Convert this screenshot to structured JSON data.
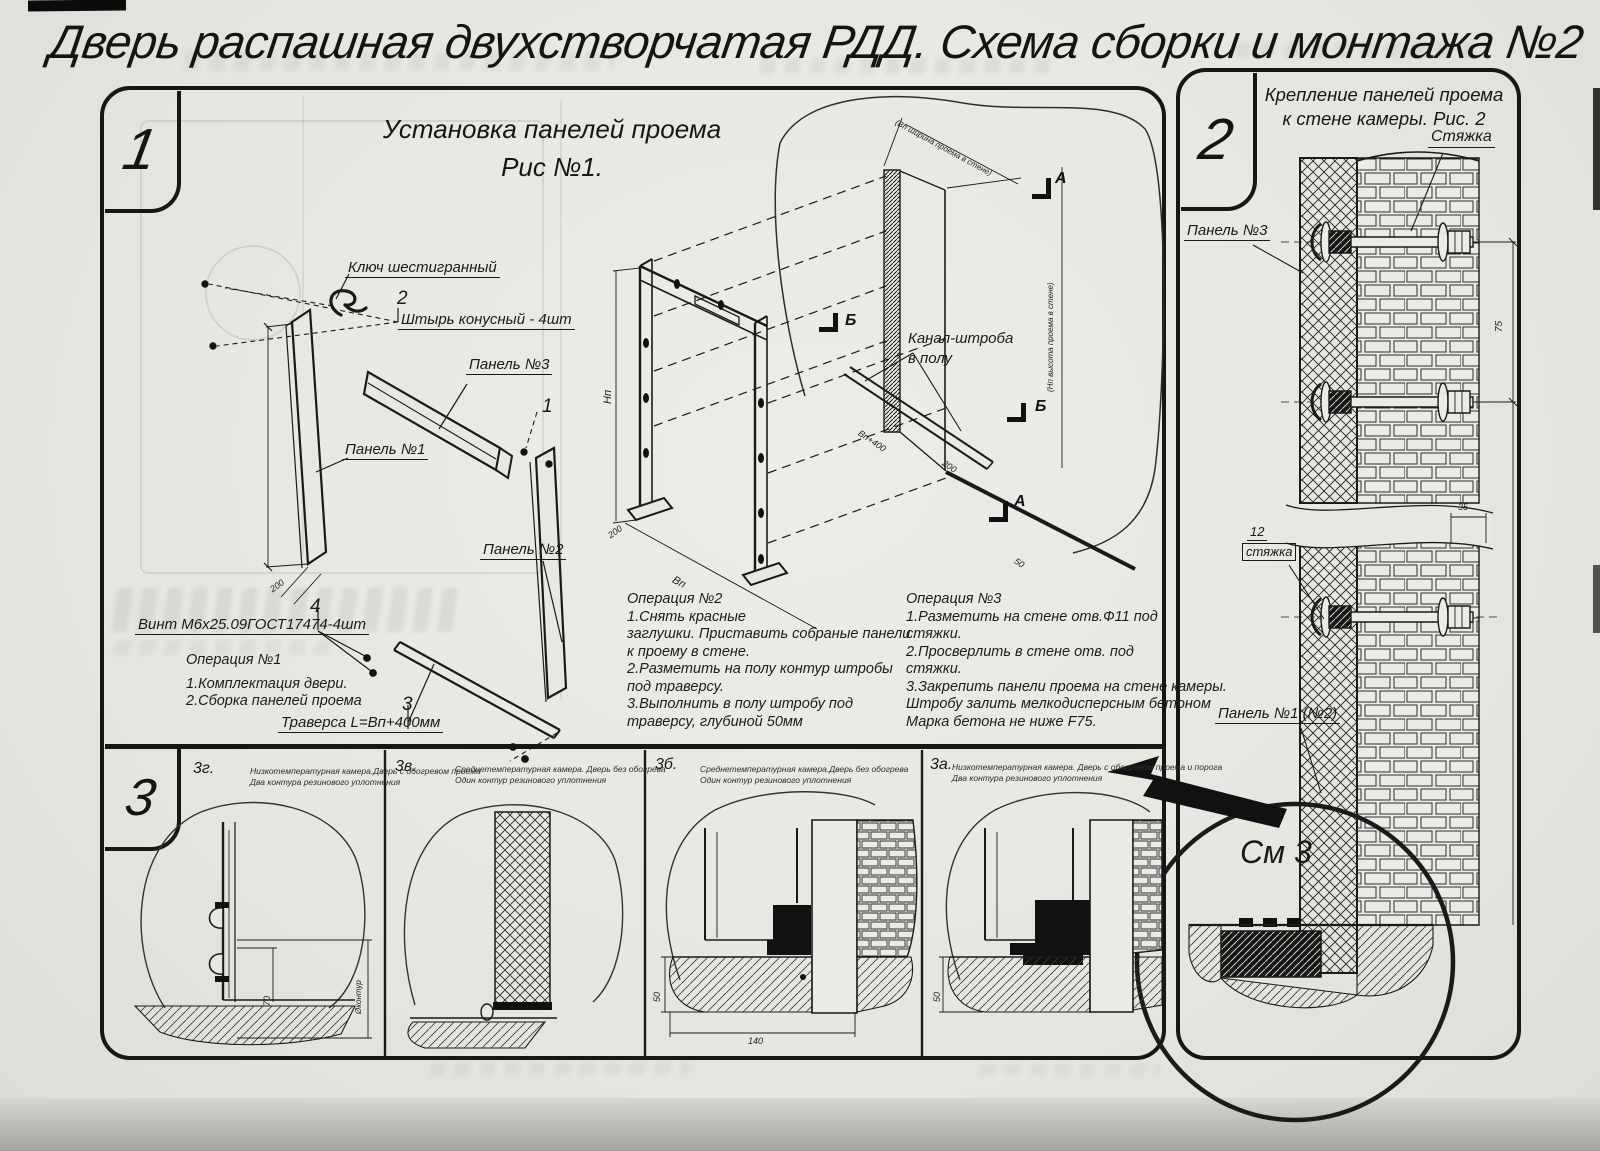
{
  "title": "Дверь распашная двухстворчатая РДД.  Схема сборки и монтажа №2",
  "section1": {
    "badge": "1",
    "heading": [
      "Установка панелей проема",
      "Рис №1."
    ],
    "labels": {
      "hex_key": "Ключ шестигранный",
      "pin_num": "2",
      "pin": "Штырь конусный - 4шт",
      "panel3": "Панель №3",
      "panel3_num": "1",
      "panel1": "Панель №1",
      "panel2": "Панель №2",
      "screw_num": "4",
      "screw": "Винт М6х25.09ГОСТ17474-4шт",
      "traverse_num": "3",
      "traverse": "Траверса  L=Bп+400мм",
      "channel_line1": "Канал-штроба",
      "channel_line2": "в полу",
      "mark_a": "А",
      "mark_b": "Б"
    },
    "dims": {
      "hp": "Hп",
      "bp": "Bп",
      "d200": "200",
      "d50": "50",
      "bp400": "Bп+400",
      "width_note": "(Bп ширина проема в стене)",
      "height_note": "(Hп высота проема в стене)"
    },
    "op1": {
      "title": "Операция №1",
      "lines": [
        "1.Комплектация двери.",
        "2.Сборка панелей проема"
      ]
    },
    "op2": {
      "title": "Операция №2",
      "lines": [
        "1.Снять красные",
        "заглушки. Приставить собраные панели",
        "к проему в стене.",
        "2.Разметить на полу контур штробы",
        "под траверсу.",
        "3.Выполнить в полу штробу под",
        "траверсу, глубиной 50мм"
      ]
    },
    "op3": {
      "title": "Операция №3",
      "lines": [
        "1.Разметить на стене отв.Ф11 под",
        "стяжки.",
        "2.Просверлить в стене отв.  под",
        "стяжки.",
        "3.Закрепить панели проема на стене камеры.",
        "Штробу залить мелкодисперсным бетоном",
        "Марка бетона не ниже  F75."
      ]
    }
  },
  "section2": {
    "badge": "2",
    "heading": [
      "Крепление панелей проема",
      "к стене камеры. Рис. 2"
    ],
    "labels": {
      "tie": "Стяжка",
      "panel3": "Панель №3",
      "tie_pos_num": "12",
      "tie_lower": "стяжка",
      "panel12": "Панель №1 (№2)",
      "see_detail": "См 3"
    },
    "dims": {
      "d75": "75",
      "d35": "35"
    }
  },
  "section3": {
    "badge": "3",
    "panels": [
      {
        "id": "3г.",
        "caption": [
          "Низкотемпературная камера.Дверь с обогревом проема",
          "Два контура резинового уплотнения"
        ],
        "dims": {
          "d70": "70",
          "contour": "Øконтур"
        }
      },
      {
        "id": "3в.",
        "caption": [
          "Среднетемпературная камера. Дверь без обогрева",
          "Один контур резинового уплотнения"
        ],
        "dims": {}
      },
      {
        "id": "3б.",
        "caption": [
          "Среднетемпературная камера.Дверь без обогрева",
          "Один контур резинового уплотнения"
        ],
        "dims": {
          "d50": "50",
          "d140": "140"
        }
      },
      {
        "id": "3а.",
        "caption": [
          "Низкотемпературная камера. Дверь с обогревом проема и порога",
          "Два контура резинового уплотнения"
        ],
        "dims": {
          "d50": "50"
        }
      }
    ]
  },
  "colors": {
    "ink": "#1a1a1a",
    "paper": "#e9e7e2"
  }
}
